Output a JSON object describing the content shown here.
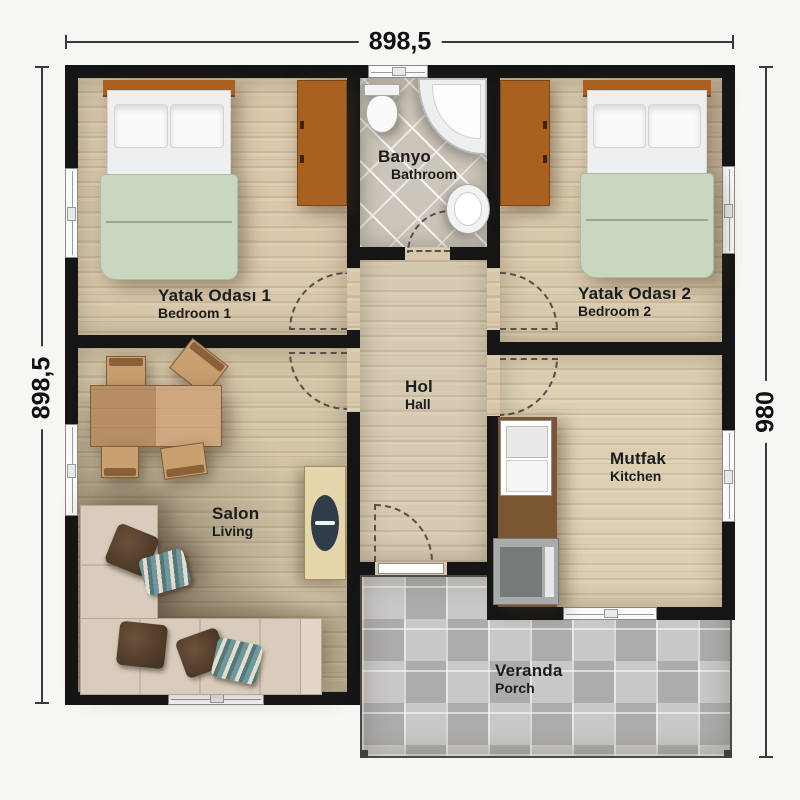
{
  "dimensions": {
    "top": "898,5",
    "left": "898,5",
    "right": "980"
  },
  "rooms": {
    "bedroom1": {
      "name": "Yatak Odası 1",
      "name_en": "Bedroom 1"
    },
    "bedroom2": {
      "name": "Yatak Odası 2",
      "name_en": "Bedroom 2"
    },
    "bathroom": {
      "name": "Banyo",
      "name_en": "Bathroom"
    },
    "hall": {
      "name": "Hol",
      "name_en": "Hall"
    },
    "living": {
      "name": "Salon",
      "name_en": "Living"
    },
    "kitchen": {
      "name": "Mutfak",
      "name_en": "Kitchen"
    },
    "porch": {
      "name": "Veranda",
      "name_en": "Porch"
    }
  },
  "colors": {
    "bg": "#f7f6f3",
    "wall": "#151515",
    "floor-wood": "#d8c7aa",
    "floor-tile": "#ccc6ba",
    "porch-tile": "#c0bebd",
    "wood-brown": "#a8611f",
    "blanket-green": "#c9d7c1",
    "sofa-beige": "#d9ccbc",
    "table-wood": "#c79a6d",
    "counter-brown": "#7a5632"
  }
}
